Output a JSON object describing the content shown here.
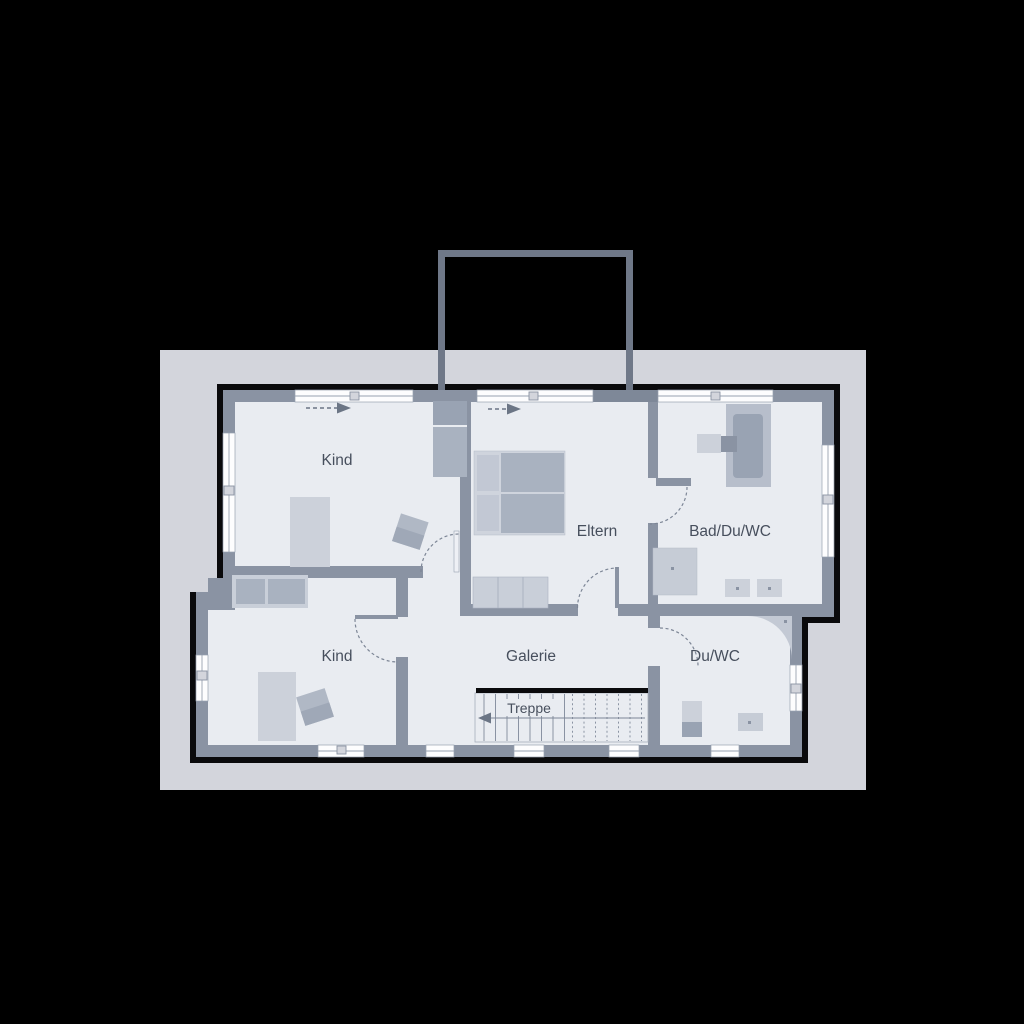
{
  "plan": {
    "title": "upper-floor-plan",
    "colors": {
      "background": "#000000",
      "site": "#d3d5dc",
      "outline": "#0a0a0c",
      "wall": "#8a93a3",
      "room_fill": "#e9ecf1",
      "window": "#fdfdfe",
      "furniture_light": "#ccd1da",
      "furniture_mid": "#b7becb",
      "furniture_dark": "#a9b2c0",
      "chimney": "#6f7888",
      "door_arc": "#7d8696",
      "label_text": "#474f5d"
    },
    "rooms": {
      "kind_top": {
        "label": "Kind"
      },
      "eltern": {
        "label": "Eltern"
      },
      "bad": {
        "label": "Bad/Du/WC"
      },
      "kind_bottom": {
        "label": "Kind"
      },
      "galerie": {
        "label": "Galerie"
      },
      "du_wc": {
        "label": "Du/WC"
      },
      "treppe": {
        "label": "Treppe"
      }
    }
  }
}
